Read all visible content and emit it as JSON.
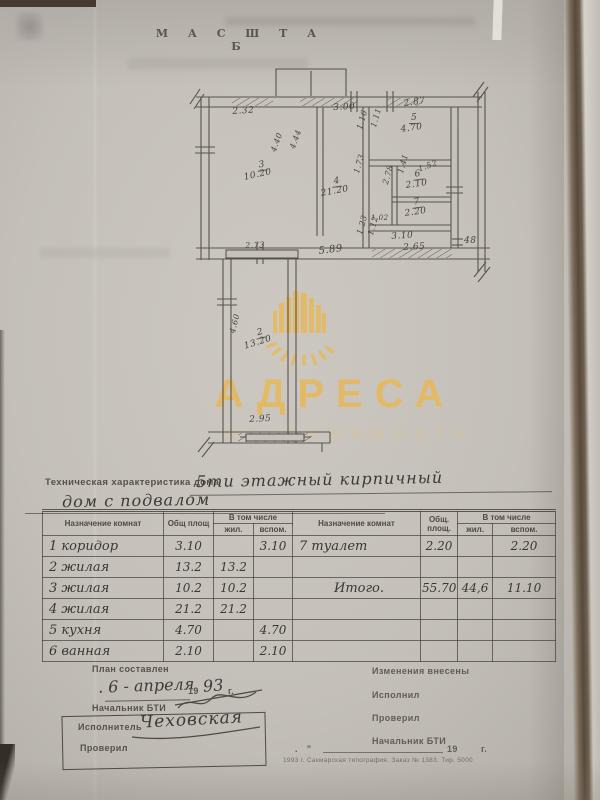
{
  "page": {
    "scale_heading": "М А С Ш Т А Б"
  },
  "watermark": {
    "brand": "АДРЕСА",
    "tagline": "НЕДВИЖИМОСТЬ",
    "gold": "#e5ba5e"
  },
  "plan": {
    "labels": [
      {
        "t": "2.32",
        "x": 232,
        "y": 107,
        "r": -4,
        "s": 9
      },
      {
        "t": "3.00",
        "x": 333,
        "y": 103,
        "r": -3,
        "s": 9
      },
      {
        "t": "2.87",
        "x": 403,
        "y": 99,
        "r": -8,
        "s": 9
      },
      {
        "t": "5",
        "x": 409,
        "y": 113,
        "r": 0,
        "s": 9,
        "u": 1
      },
      {
        "t": "4.70",
        "x": 400,
        "y": 125,
        "r": -8,
        "s": 9
      },
      {
        "t": "1.16",
        "x": 355,
        "y": 128,
        "r": -74,
        "s": 8
      },
      {
        "t": "1.11",
        "x": 369,
        "y": 126,
        "r": -74,
        "s": 8
      },
      {
        "t": "4.40",
        "x": 269,
        "y": 150,
        "r": -70,
        "s": 8
      },
      {
        "t": "4.44",
        "x": 288,
        "y": 147,
        "r": -70,
        "s": 8
      },
      {
        "t": "3",
        "x": 256,
        "y": 161,
        "r": -10,
        "s": 9,
        "u": 1
      },
      {
        "t": "10.20",
        "x": 243,
        "y": 173,
        "r": -12,
        "s": 9
      },
      {
        "t": "4",
        "x": 331,
        "y": 177,
        "r": -8,
        "s": 9,
        "u": 1
      },
      {
        "t": "21.20",
        "x": 320,
        "y": 189,
        "r": -10,
        "s": 9
      },
      {
        "t": "1.73",
        "x": 352,
        "y": 172,
        "r": -74,
        "s": 8
      },
      {
        "t": "2.78",
        "x": 381,
        "y": 183,
        "r": -74,
        "s": 8
      },
      {
        "t": "1.41",
        "x": 396,
        "y": 172,
        "r": -74,
        "s": 8
      },
      {
        "t": "6",
        "x": 412,
        "y": 170,
        "r": -8,
        "s": 9,
        "u": 1
      },
      {
        "t": "2.10",
        "x": 405,
        "y": 181,
        "r": -8,
        "s": 9
      },
      {
        "t": "1.52",
        "x": 417,
        "y": 165,
        "r": -20,
        "s": 8
      },
      {
        "t": "7",
        "x": 411,
        "y": 198,
        "r": -8,
        "s": 9,
        "u": 1
      },
      {
        "t": "2.20",
        "x": 404,
        "y": 209,
        "r": -8,
        "s": 9
      },
      {
        "t": "1.02",
        "x": 371,
        "y": 214,
        "r": 0,
        "s": 7
      },
      {
        "t": "1.23",
        "x": 355,
        "y": 233,
        "r": -74,
        "s": 8
      },
      {
        "t": "1.12",
        "x": 366,
        "y": 234,
        "r": -74,
        "s": 8
      },
      {
        "t": "3.10",
        "x": 391,
        "y": 232,
        "r": -4,
        "s": 9
      },
      {
        "t": "2.65",
        "x": 403,
        "y": 243,
        "r": -3,
        "s": 9
      },
      {
        "t": "48",
        "x": 464,
        "y": 236,
        "r": 0,
        "s": 9
      },
      {
        "t": "5.89",
        "x": 318,
        "y": 246,
        "r": -7,
        "s": 10
      },
      {
        "t": "2.73",
        "x": 245,
        "y": 241,
        "r": -2,
        "s": 8
      },
      {
        "t": "2",
        "x": 254,
        "y": 329,
        "r": -14,
        "s": 9,
        "u": 1
      },
      {
        "t": "13.20",
        "x": 243,
        "y": 342,
        "r": -17,
        "s": 9
      },
      {
        "t": "4.60",
        "x": 228,
        "y": 332,
        "r": -76,
        "s": 8
      },
      {
        "t": "2.95",
        "x": 249,
        "y": 415,
        "r": -3,
        "s": 9
      }
    ]
  },
  "doc": {
    "tech_label": "Техническая характеристика дома",
    "tech_line1": "5ти этажный кирпичный",
    "tech_line2": "дом с подвалом"
  },
  "table": {
    "headers": {
      "purpose": "Назначение комнат",
      "total": "Общ площ",
      "including": "В том числе",
      "living": "жил.",
      "aux": "вспом.",
      "purpose2": "Назначение комнат",
      "total2a": "Общ.",
      "total2b": "площ.",
      "including2": "В том числе",
      "living2": "жил.",
      "aux2": "вспом."
    },
    "rows": [
      {
        "left": [
          "1 коридор",
          "3.10",
          "",
          "3.10"
        ],
        "right": [
          "7 туалет",
          "2.20",
          "",
          "2.20"
        ]
      },
      {
        "left": [
          "2 жилая",
          "13.2",
          "13.2",
          ""
        ],
        "right": [
          "",
          "",
          "",
          ""
        ]
      },
      {
        "left": [
          "3 жилая",
          "10.2",
          "10.2",
          ""
        ],
        "right": [
          "Итого.",
          "55.70",
          "44,6",
          "11.10"
        ]
      },
      {
        "left": [
          "4 жилая",
          "21.2",
          "21.2",
          ""
        ],
        "right": [
          "",
          "",
          "",
          ""
        ]
      },
      {
        "left": [
          "5 кухня",
          "4.70",
          "",
          "4.70"
        ],
        "right": [
          "",
          "",
          "",
          ""
        ]
      },
      {
        "left": [
          "6 ванная",
          "2.10",
          "",
          "2.10"
        ],
        "right": [
          "",
          "",
          "",
          ""
        ]
      }
    ]
  },
  "footer": {
    "plan_made": "План составлен",
    "date_hw": ". 6 - апреля",
    "year_pre": "19",
    "year_hw": "93",
    "year_suf": "г.",
    "chief": "Начальник БТИ",
    "executor": "Исполнитель",
    "executor_sign": "Чеховская",
    "checked": "Проверил",
    "changes": "Изменения внесены",
    "done_by": "Исполнил",
    "checked2": "Проверил",
    "chief2": "Начальник БТИ",
    "blank_year": "19",
    "blank_g": "г.",
    "print_info": "1993 г.  Сакмарская типография.  Заказ № 1383.  Тир. 5000"
  }
}
